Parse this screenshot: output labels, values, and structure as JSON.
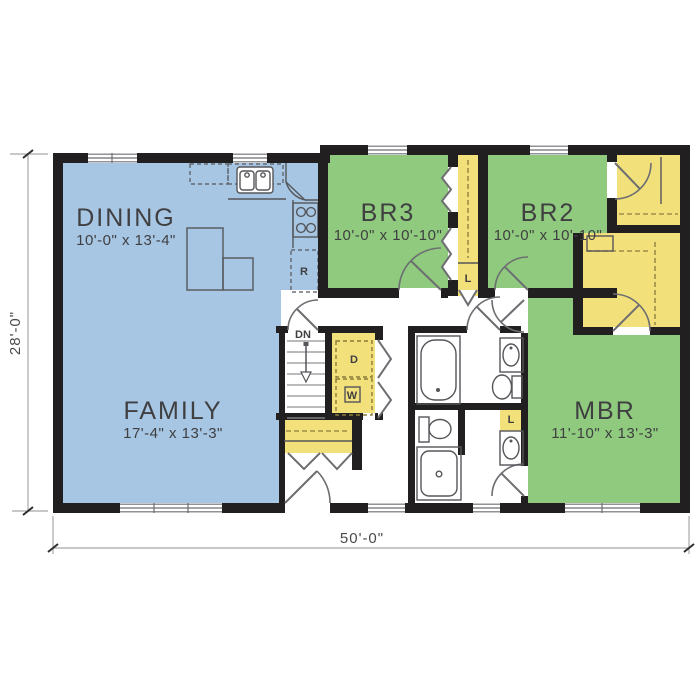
{
  "plan": {
    "rooms": {
      "dining": {
        "name": "DINING",
        "dims": "10'-0\" x 13'-4\""
      },
      "family": {
        "name": "FAMILY",
        "dims": "17'-4\" x 13'-3\""
      },
      "br3": {
        "name": "BR3",
        "dims": "10'-0\" x 10'-10\""
      },
      "br2": {
        "name": "BR2",
        "dims": "10'-0\" x 10'-10\""
      },
      "mbr": {
        "name": "MBR",
        "dims": "11'-10\" x 13'-3\""
      }
    },
    "annotations": {
      "stairs_down": "DN",
      "dryer": "D",
      "washer": "W",
      "refrigerator": "R",
      "linen_hall": "L",
      "linen_bath": "L"
    },
    "overall_dimensions": {
      "width": "50'-0\"",
      "depth": "28'-0\""
    },
    "colors": {
      "living_area": "#a7c6e3",
      "bedroom": "#8fca7e",
      "closet": "#f2e07b",
      "wall": "#221f20",
      "fixture_line": "#55565a",
      "dimension_line": "#a6a8ab"
    }
  }
}
